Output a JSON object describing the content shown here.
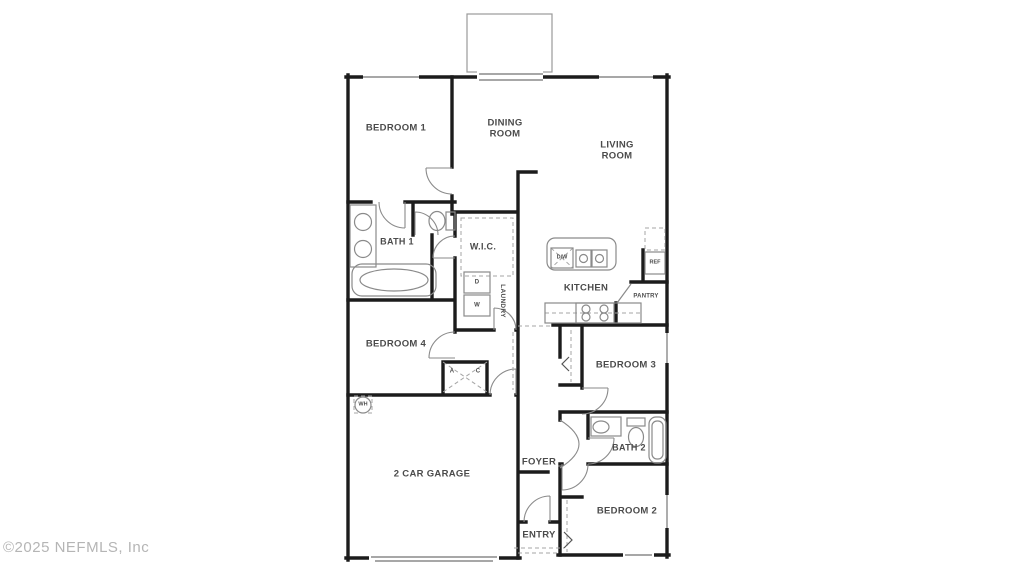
{
  "watermark": "©2025 NEFMLS, Inc",
  "colors": {
    "background": "#ffffff",
    "wall": "#1c1c1c",
    "thin_line": "#8a8a8a",
    "dashed_line": "#a5a5a5",
    "label_text": "#4b4b4b",
    "watermark_text": "#b5b5b5"
  },
  "floor_plan": {
    "rooms": {
      "bedroom1": "BEDROOM 1",
      "dining_room": "DINING\nROOM",
      "living_room": "LIVING\nROOM",
      "bath1": "BATH 1",
      "wic": "W.I.C.",
      "laundry": "LAUNDRY",
      "kitchen": "KITCHEN",
      "pantry": "PANTRY",
      "bedroom4": "BEDROOM 4",
      "bedroom3": "BEDROOM 3",
      "bath2": "BATH 2",
      "bedroom2": "BEDROOM 2",
      "garage": "2 CAR GARAGE",
      "foyer": "FOYER",
      "entry": "ENTRY"
    },
    "fixtures": {
      "refrigerator": "REF",
      "dishwasher": "D/W",
      "dryer": "D",
      "washer": "W",
      "air_handler_a": "A",
      "air_handler_c": "C",
      "water_heater": "WH"
    }
  }
}
